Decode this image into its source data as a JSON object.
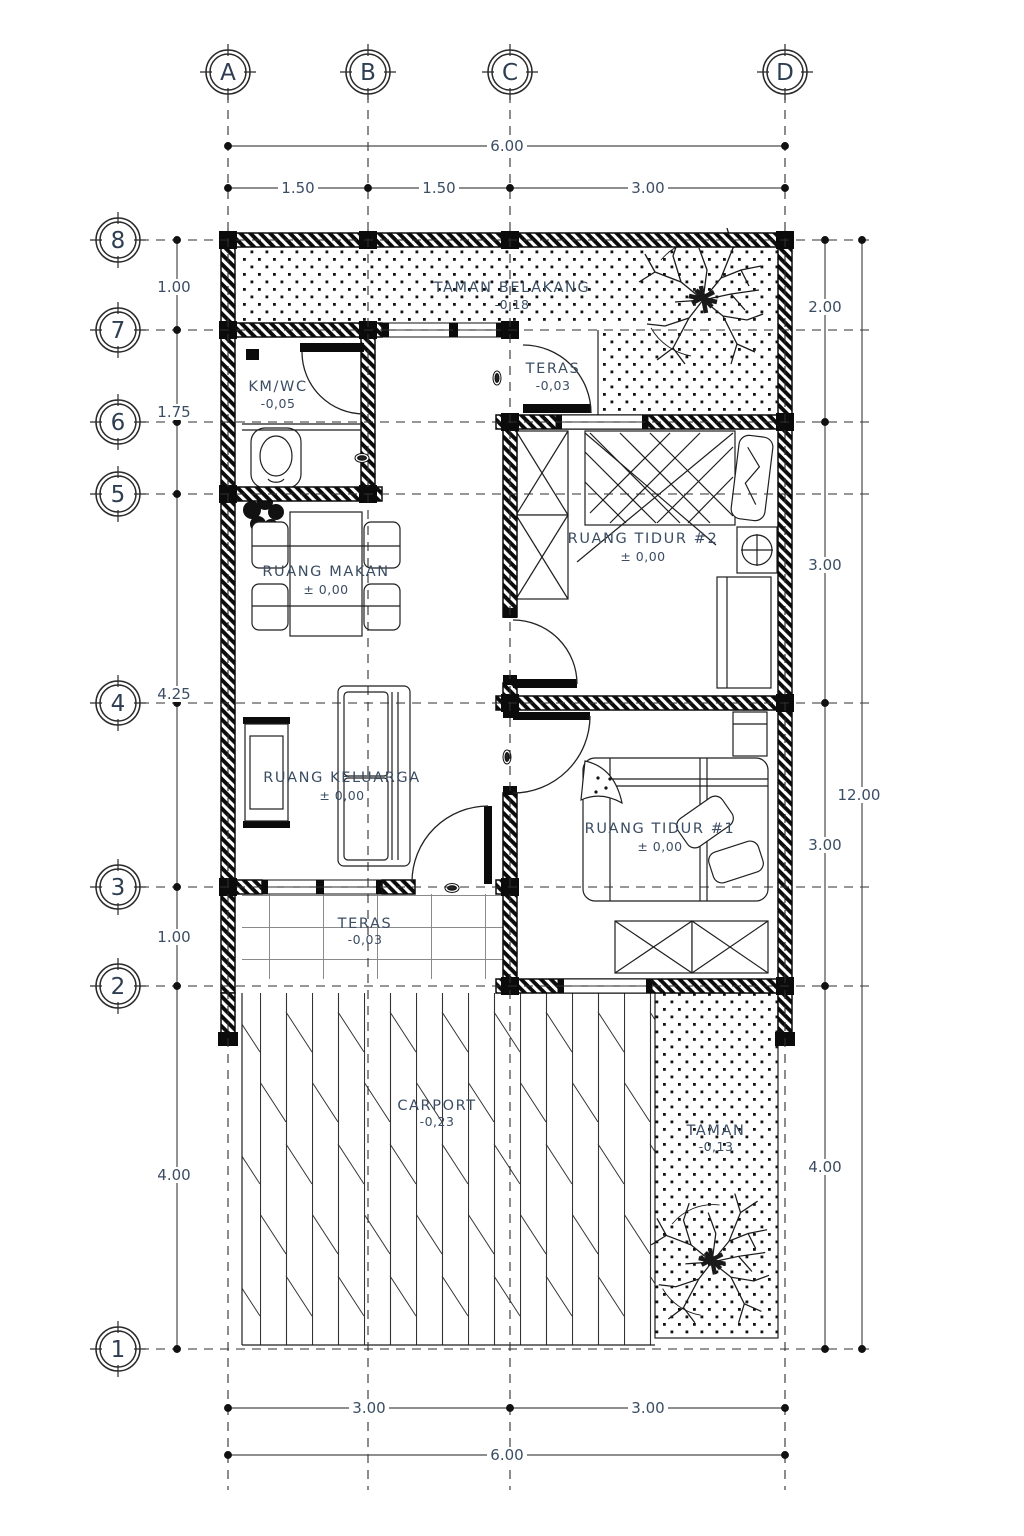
{
  "drawing_type": "floor-plan",
  "grid": {
    "cols": [
      "A",
      "B",
      "C",
      "D"
    ],
    "rows": [
      "8",
      "7",
      "6",
      "5",
      "4",
      "3",
      "2",
      "1"
    ]
  },
  "dims": {
    "top_total": "6.00",
    "top_segments": [
      "1.50",
      "1.50",
      "3.00"
    ],
    "bottom_segments": [
      "3.00",
      "3.00"
    ],
    "bottom_total": "6.00",
    "left": [
      "1.00",
      "1.75",
      "4.25",
      "1.00",
      "4.00"
    ],
    "right": [
      "2.00",
      "3.00",
      "3.00",
      "4.00"
    ],
    "right_total": "12.00"
  },
  "rooms": {
    "taman_belakang": {
      "name": "TAMAN BELAKANG",
      "elevation": "-0,18"
    },
    "km_wc": {
      "name": "KM/WC",
      "elevation": "-0,05"
    },
    "teras_atas": {
      "name": "TERAS",
      "elevation": "-0,03"
    },
    "ruang_tidur_2": {
      "name": "RUANG TIDUR #2",
      "elevation": "± 0,00"
    },
    "ruang_makan": {
      "name": "RUANG MAKAN",
      "elevation": "± 0,00"
    },
    "ruang_keluarga": {
      "name": "RUANG KELUARGA",
      "elevation": "± 0,00"
    },
    "ruang_tidur_1": {
      "name": "RUANG TIDUR #1",
      "elevation": "± 0,00"
    },
    "teras_depan": {
      "name": "TERAS",
      "elevation": "-0,03"
    },
    "carport": {
      "name": "CARPORT",
      "elevation": "-0,23"
    },
    "taman": {
      "name": "TAMAN",
      "elevation": "-0,13"
    }
  },
  "colors": {
    "label_text": "#3b4d63",
    "wall": "#0b0b0b",
    "dim_line": "#4a4a4a",
    "background": "#ffffff"
  }
}
